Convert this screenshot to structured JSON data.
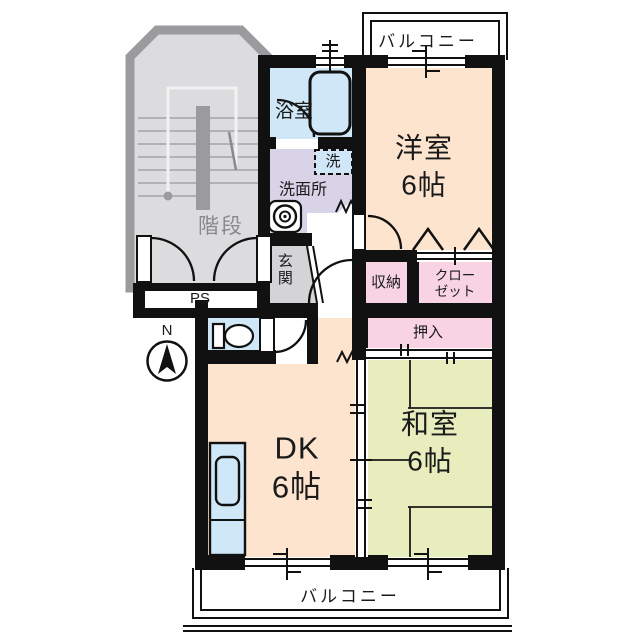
{
  "floorplan": {
    "compass": "N",
    "balcony_top": "バルコニー",
    "balcony_bottom": "バルコニー",
    "stairs": "階段",
    "pipe_space": "PS",
    "entrance": "玄関",
    "bathroom": "浴室",
    "washroom": "洗面所",
    "washing_machine": "洗",
    "storage": "収納",
    "closet_line1": "クロー",
    "closet_line2": "ゼット",
    "futon_closet": "押入",
    "western_room": {
      "name": "洋室",
      "size": "6帖"
    },
    "dining_kitchen": {
      "name": "DK",
      "size": "6帖"
    },
    "japanese_room": {
      "name": "和室",
      "size": "6帖"
    }
  },
  "colors": {
    "wall": "#111111",
    "western_room_fill": "#fce4cf",
    "dk_fill": "#fce4cf",
    "japanese_room_fill": "#e8edbe",
    "wet_area_fill": "#cfe7f7",
    "washroom_fill": "#d9d3e8",
    "closet_fill": "#f8d3e3",
    "entrance_fill": "#d4d4d6",
    "stair_fill": "#dcdcde",
    "stair_border": "#9b9b9d"
  }
}
